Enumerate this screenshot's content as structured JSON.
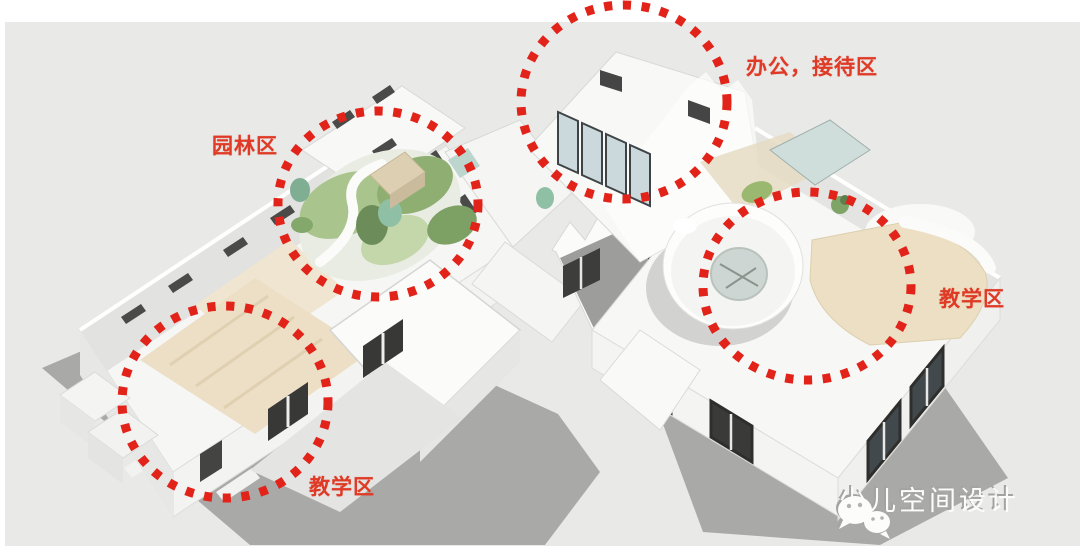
{
  "scene": {
    "type": "axonometric-floorplan-zoning-diagram",
    "colors": {
      "canvas_bg": "#e9e9e8",
      "page_margin": "#ffffff",
      "annotation_dot_red": "#e2231a",
      "label_red": "#df3a25",
      "building_white": "#f7f7f6",
      "shadow_gray": "#a9a9a8",
      "floor_cream": "#ecdfc6",
      "garden_green": "#9dbb80",
      "glass_blue": "#ccd9dc",
      "window_dark": "#454544",
      "watermark_white": "#fcfcfb"
    }
  },
  "zones": [
    {
      "id": "garden",
      "label": "园林区"
    },
    {
      "id": "office-reception",
      "label": "办公，接待区"
    },
    {
      "id": "teaching-right",
      "label": "教学区"
    },
    {
      "id": "teaching-left",
      "label": "教学区"
    }
  ],
  "watermark": {
    "text": "少儿空间设计",
    "icon": "wechat-icon"
  }
}
